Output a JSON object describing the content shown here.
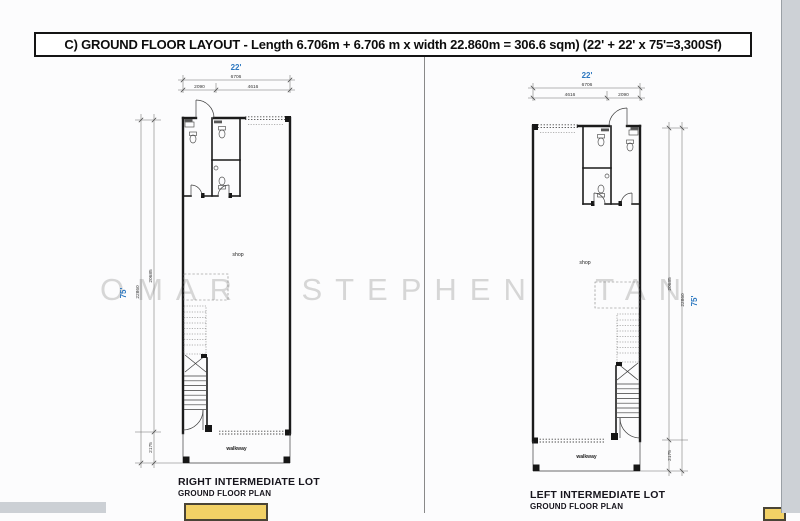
{
  "header": {
    "title": "C)  GROUND FLOOR LAYOUT - Length 6.706m + 6.706 m  x width 22.860m = 306.6 sqm) (22' + 22' x 75'=3,300Sf)"
  },
  "watermark": {
    "words": [
      "OMAR",
      "STEPHEN",
      "TAN"
    ]
  },
  "plans": {
    "left": {
      "width_feet": "22'",
      "height_feet": "75'",
      "dim_total_width": "6706",
      "dim_segments": [
        "2090",
        "4616"
      ],
      "dim_total_height": "22860",
      "dim_inner_height": "20685",
      "dim_walkway": "2175",
      "room_label": "shop",
      "walkway_label": "walkway",
      "caption": "RIGHT INTERMEDIATE LOT",
      "subcaption": "GROUND FLOOR PLAN"
    },
    "right": {
      "width_feet": "22'",
      "height_feet": "75'",
      "dim_total_width": "6706",
      "dim_segments": [
        "4616",
        "2090"
      ],
      "dim_total_height": "22860",
      "dim_inner_height": "20685",
      "dim_walkway": "2175",
      "room_label": "shop",
      "walkway_label": "walkway",
      "caption": "LEFT INTERMEDIATE LOT",
      "subcaption": "GROUND FLOOR PLAN"
    }
  },
  "colors": {
    "annotation_blue": "#2d78c0",
    "highlight_yellow": "#f2d166",
    "watermark_gray": "#d6d6d6",
    "page_edge_gray": "#cdd1d6"
  }
}
